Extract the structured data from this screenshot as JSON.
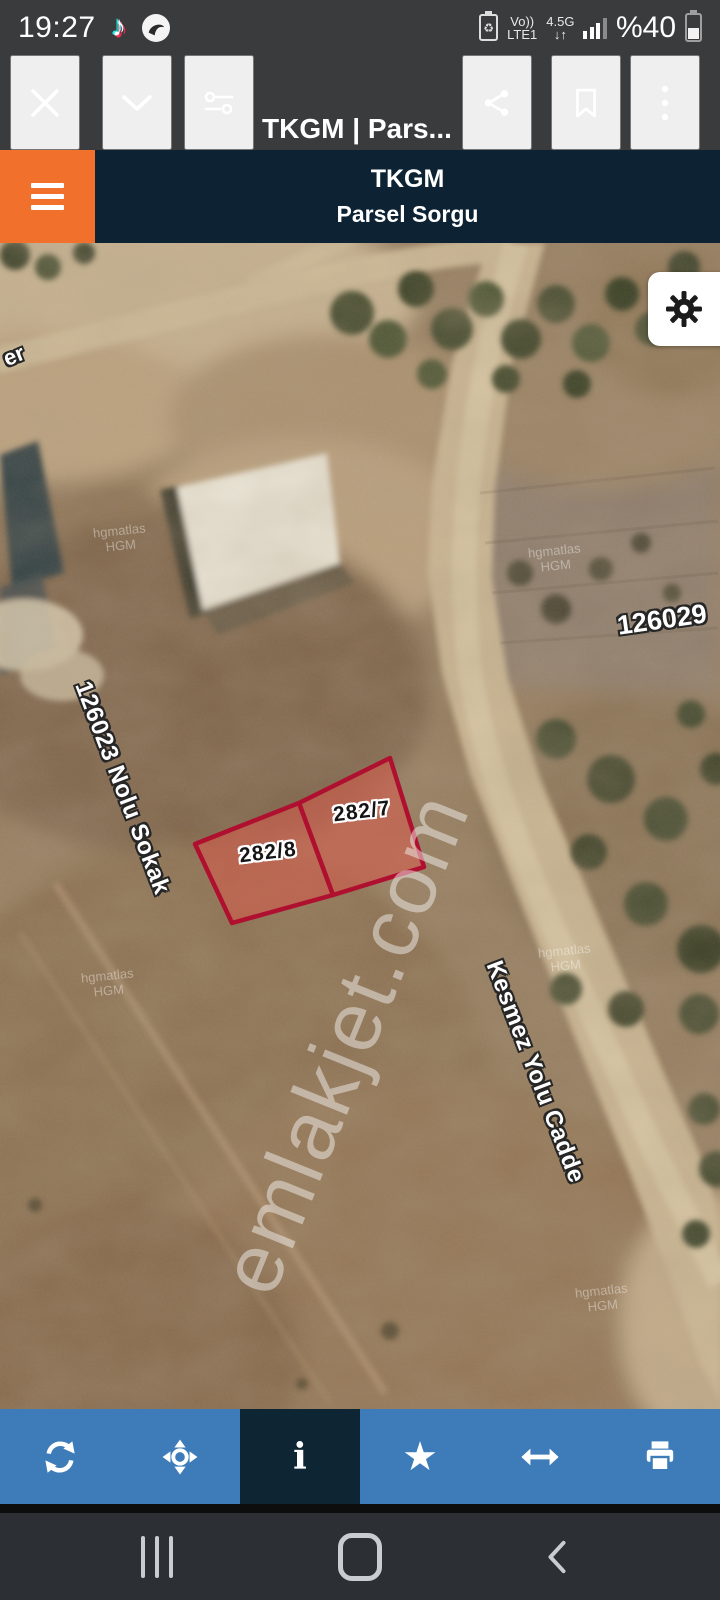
{
  "status_bar": {
    "time": "19:27",
    "volte": {
      "top": "Vo))",
      "bottom": "LTE1"
    },
    "network": {
      "top": "4.5G",
      "bottom": "↓↑"
    },
    "battery_percent": "%40"
  },
  "browser": {
    "page_title": "TKGM | Pars...",
    "url": "selsorgu.tkgm.gov.tr"
  },
  "app_header": {
    "title": "TKGM",
    "subtitle": "Parsel Sorgu"
  },
  "map": {
    "parcels": [
      {
        "id": "282/7"
      },
      {
        "id": "282/8"
      }
    ],
    "street_labels": {
      "edge_partial": "er",
      "left_block": "126023 Nolu Sokak",
      "right_block": "126029",
      "road": "Kesmez Yolu Cadde"
    },
    "watermark": "emlakjet.com",
    "imagery_credit": {
      "line1": "hgmatlas",
      "line2": "HGM"
    }
  },
  "toolbar": {
    "items": [
      {
        "icon": "refresh-icon",
        "selected": false
      },
      {
        "icon": "locate-icon",
        "selected": false
      },
      {
        "icon": "info-icon",
        "selected": true,
        "glyph": "i"
      },
      {
        "icon": "star-icon",
        "selected": false,
        "glyph": "★"
      },
      {
        "icon": "resize-horizontal-icon",
        "selected": false
      },
      {
        "icon": "print-icon",
        "selected": false
      }
    ]
  },
  "android_nav": {
    "buttons": [
      "recents",
      "home",
      "back"
    ]
  },
  "colors": {
    "accent_orange": "#f1702b",
    "header_navy": "#0d2334",
    "toolbar_blue": "#3d7cb8",
    "toolbar_selected": "#0e2534",
    "parcel_red": "#b01030",
    "parcel_fill": "#d95a4a",
    "statusbar_gray": "#3a3b3d"
  }
}
